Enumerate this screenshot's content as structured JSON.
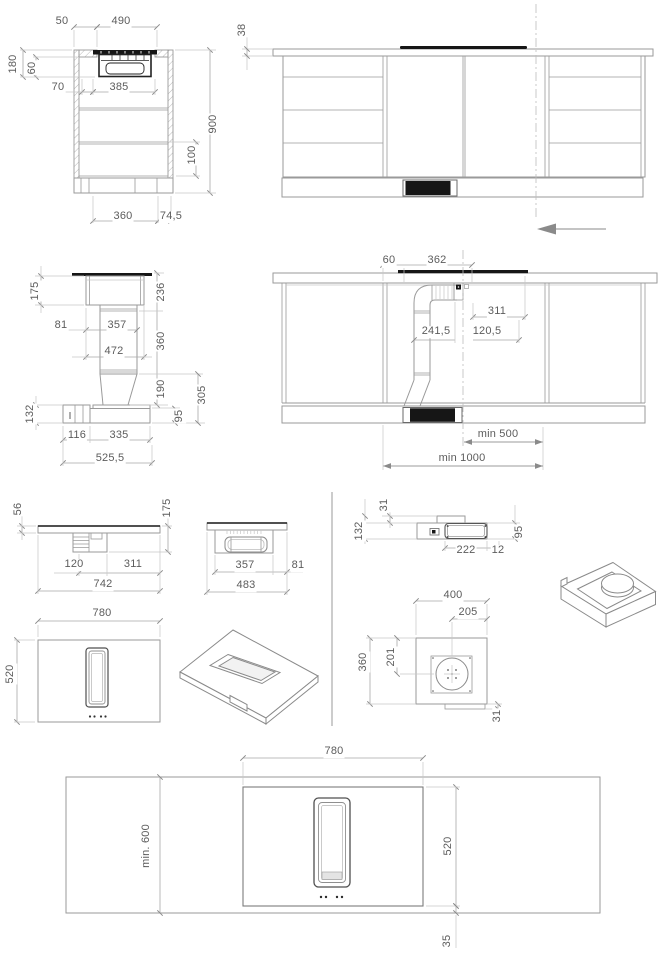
{
  "meta": {
    "type": "appliance-installation-dimension-drawing",
    "subject": "downdraft extractor hob in kitchen cabinet",
    "units": "mm"
  },
  "colors": {
    "background": "#ffffff",
    "line": "#9a9a9a",
    "dark_fill": "#161616",
    "dimension_text": "#5c5c5c"
  },
  "views": {
    "cabinet_section_side": {
      "title": "cabinet cross section with hob",
      "labels": [
        {
          "text": "50",
          "x": 62,
          "y": 22,
          "rot": 0
        },
        {
          "text": "490",
          "x": 121,
          "y": 22,
          "rot": 0
        },
        {
          "text": "180",
          "x": 14,
          "y": 64,
          "rot": 1
        },
        {
          "text": "60",
          "x": 33,
          "y": 68,
          "rot": 1
        },
        {
          "text": "70",
          "x": 58,
          "y": 88,
          "rot": 0
        },
        {
          "text": "385",
          "x": 119,
          "y": 88,
          "rot": 0
        },
        {
          "text": "900",
          "x": 214,
          "y": 124,
          "rot": 1
        },
        {
          "text": "100",
          "x": 193,
          "y": 155,
          "rot": 1
        },
        {
          "text": "360",
          "x": 123,
          "y": 217,
          "rot": 0
        },
        {
          "text": "74,5",
          "x": 171,
          "y": 217,
          "rot": 0
        }
      ]
    },
    "cabinet_front_elevation": {
      "title": "cabinet front elevation with worktop",
      "labels": [
        {
          "text": "38",
          "x": 243,
          "y": 30,
          "rot": 1
        }
      ]
    },
    "downdraft_unit_section": {
      "title": "downdraft unit vertical section",
      "labels": [
        {
          "text": "175",
          "x": 36,
          "y": 291,
          "rot": 1
        },
        {
          "text": "236",
          "x": 162,
          "y": 292,
          "rot": 1
        },
        {
          "text": "81",
          "x": 61,
          "y": 326,
          "rot": 0
        },
        {
          "text": "357",
          "x": 117,
          "y": 326,
          "rot": 0
        },
        {
          "text": "360",
          "x": 162,
          "y": 341,
          "rot": 1
        },
        {
          "text": "472",
          "x": 114,
          "y": 352,
          "rot": 0
        },
        {
          "text": "190",
          "x": 162,
          "y": 389,
          "rot": 1
        },
        {
          "text": "305",
          "x": 203,
          "y": 395,
          "rot": 1
        },
        {
          "text": "132",
          "x": 31,
          "y": 414,
          "rot": 1
        },
        {
          "text": "95",
          "x": 180,
          "y": 416,
          "rot": 1
        },
        {
          "text": "116",
          "x": 77,
          "y": 436,
          "rot": 0
        },
        {
          "text": "335",
          "x": 119,
          "y": 436,
          "rot": 0
        },
        {
          "text": "525,5",
          "x": 110,
          "y": 459,
          "rot": 0
        }
      ]
    },
    "cabinet_duct_section": {
      "title": "cabinet section with duct run",
      "labels": [
        {
          "text": "60",
          "x": 389,
          "y": 261,
          "rot": 0
        },
        {
          "text": "362",
          "x": 437,
          "y": 261,
          "rot": 0
        },
        {
          "text": "311",
          "x": 497,
          "y": 312,
          "rot": 0
        },
        {
          "text": "241,5",
          "x": 436,
          "y": 332,
          "rot": 0
        },
        {
          "text": "120,5",
          "x": 487,
          "y": 332,
          "rot": 0
        },
        {
          "text": "min 500",
          "x": 498,
          "y": 435,
          "rot": 0
        },
        {
          "text": "min 1000",
          "x": 462,
          "y": 459,
          "rot": 0
        }
      ]
    },
    "hob_side_long": {
      "title": "hob side view long edge",
      "labels": [
        {
          "text": "56",
          "x": 19,
          "y": 509,
          "rot": 1
        },
        {
          "text": "175",
          "x": 168,
          "y": 508,
          "rot": 1
        },
        {
          "text": "120",
          "x": 74,
          "y": 565,
          "rot": 0
        },
        {
          "text": "311",
          "x": 133,
          "y": 565,
          "rot": 0
        },
        {
          "text": "742",
          "x": 103,
          "y": 585,
          "rot": 0
        }
      ]
    },
    "hob_side_short": {
      "title": "hob side view short edge",
      "labels": [
        {
          "text": "357",
          "x": 245,
          "y": 566,
          "rot": 0
        },
        {
          "text": "81",
          "x": 298,
          "y": 566,
          "rot": 0
        },
        {
          "text": "483",
          "x": 246,
          "y": 586,
          "rot": 0
        }
      ]
    },
    "fan_unit_side": {
      "title": "fan unit side view",
      "labels": [
        {
          "text": "31",
          "x": 385,
          "y": 505,
          "rot": 1
        },
        {
          "text": "132",
          "x": 360,
          "y": 531,
          "rot": 1
        },
        {
          "text": "95",
          "x": 520,
          "y": 532,
          "rot": 1
        },
        {
          "text": "222",
          "x": 466,
          "y": 551,
          "rot": 0
        },
        {
          "text": "12",
          "x": 498,
          "y": 551,
          "rot": 0
        }
      ]
    },
    "fan_unit_top": {
      "title": "fan unit top view",
      "labels": [
        {
          "text": "400",
          "x": 453,
          "y": 596,
          "rot": 0
        },
        {
          "text": "205",
          "x": 468,
          "y": 613,
          "rot": 0
        },
        {
          "text": "360",
          "x": 364,
          "y": 662,
          "rot": 1
        },
        {
          "text": "201",
          "x": 392,
          "y": 657,
          "rot": 1
        },
        {
          "text": "31",
          "x": 498,
          "y": 716,
          "rot": 1
        }
      ]
    },
    "hob_top": {
      "title": "hob top view",
      "labels": [
        {
          "text": "780",
          "x": 102,
          "y": 614,
          "rot": 0
        },
        {
          "text": "520",
          "x": 11,
          "y": 674,
          "rot": 1
        }
      ]
    },
    "worktop_plan": {
      "title": "worktop plan with hob cutout",
      "labels": [
        {
          "text": "780",
          "x": 334,
          "y": 752,
          "rot": 0
        },
        {
          "text": "min. 600",
          "x": 147,
          "y": 846,
          "rot": 1
        },
        {
          "text": "520",
          "x": 449,
          "y": 846,
          "rot": 1
        },
        {
          "text": "35",
          "x": 448,
          "y": 941,
          "rot": 1
        }
      ]
    }
  }
}
